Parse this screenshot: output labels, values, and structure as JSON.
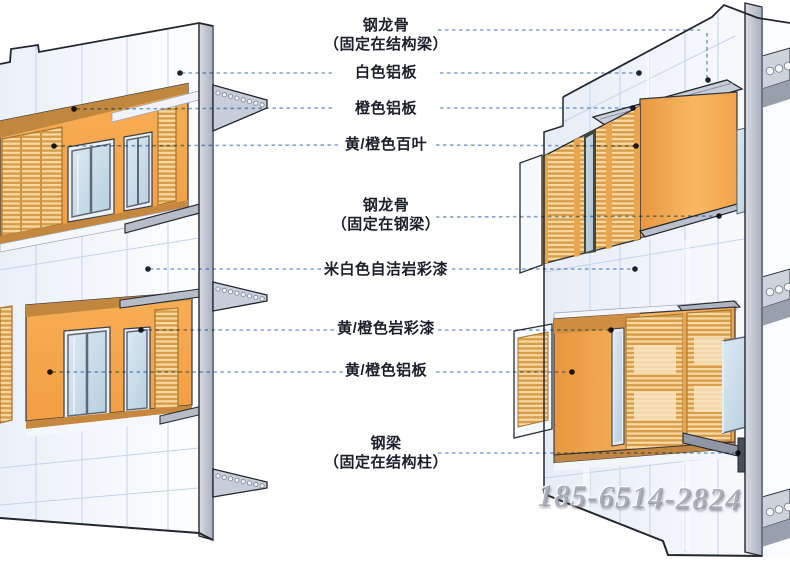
{
  "diagram": {
    "type": "architectural-facade-detail",
    "views": [
      "left-axonometric-facade",
      "right-axonometric-facade"
    ]
  },
  "labels": [
    {
      "line1": "钢龙骨",
      "line2": "（固定在结构梁）"
    },
    {
      "line1": "白色铝板"
    },
    {
      "line1": "橙色铝板"
    },
    {
      "line1": "黄/橙色百叶"
    },
    {
      "line1": "钢龙骨",
      "line2": "（固定在钢梁）"
    },
    {
      "line1": "米白色自洁岩彩漆"
    },
    {
      "line1": "黄/橙色岩彩漆"
    },
    {
      "line1": "黄/橙色铝板"
    },
    {
      "line1": "钢梁",
      "line2": "（固定在结构柱）"
    }
  ],
  "watermark": {
    "text": "185-6514-2824"
  },
  "colors": {
    "orange": "#F5A64C",
    "orange_light": "#F9BC6E",
    "orange_dark": "#C8883C",
    "louver_light": "#F5DAA8",
    "louver_dark": "#DB9C46",
    "glass": "#C6DBE9",
    "steel": "#C5CBD6",
    "white_panel": "#F7FAFE",
    "panel_line": "#C3D3EC",
    "leader_blue": "#7FA3D8",
    "text": "#1B1F2A"
  }
}
